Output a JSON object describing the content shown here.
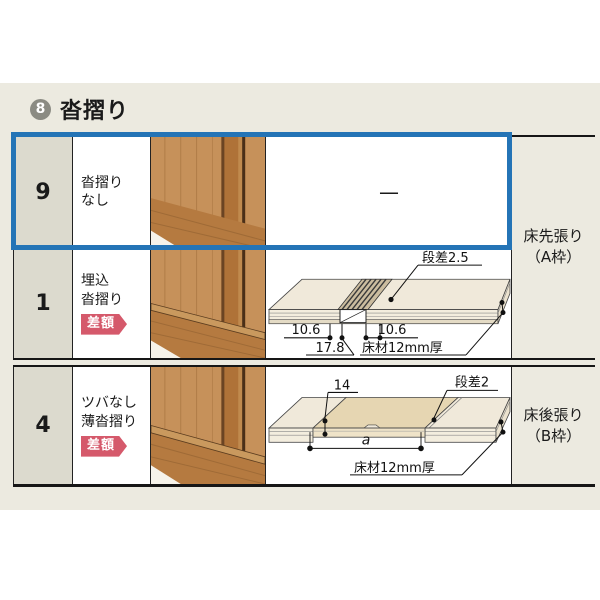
{
  "header": {
    "number": "8",
    "title": "沓摺り"
  },
  "rows": [
    {
      "num": "9",
      "name_line1": "沓摺り",
      "name_line2": "なし",
      "diagram_placeholder": "—"
    },
    {
      "num": "1",
      "name_line1": "埋込",
      "name_line2": "沓摺り",
      "badge": "差額"
    },
    {
      "num": "4",
      "name_line1": "ツバなし",
      "name_line2": "薄沓摺り",
      "badge": "差額"
    }
  ],
  "side_labels": [
    {
      "line1": "床先張り",
      "line2": "（A枠）"
    },
    {
      "line1": "床後張り",
      "line2": "（B枠）"
    }
  ],
  "diagrams": {
    "embedded": {
      "step": "段差2.5",
      "dim_left": "10.6",
      "dim_right": "10.6",
      "dim_total": "17.8",
      "material": "床材12mm厚"
    },
    "thin": {
      "dim_width": "14",
      "step": "段差2",
      "span": "a",
      "material": "床材12mm厚"
    }
  },
  "colors": {
    "highlight_blue": "#2474b6",
    "badge_red": "#d5596b",
    "band_beige": "#eceae0"
  }
}
